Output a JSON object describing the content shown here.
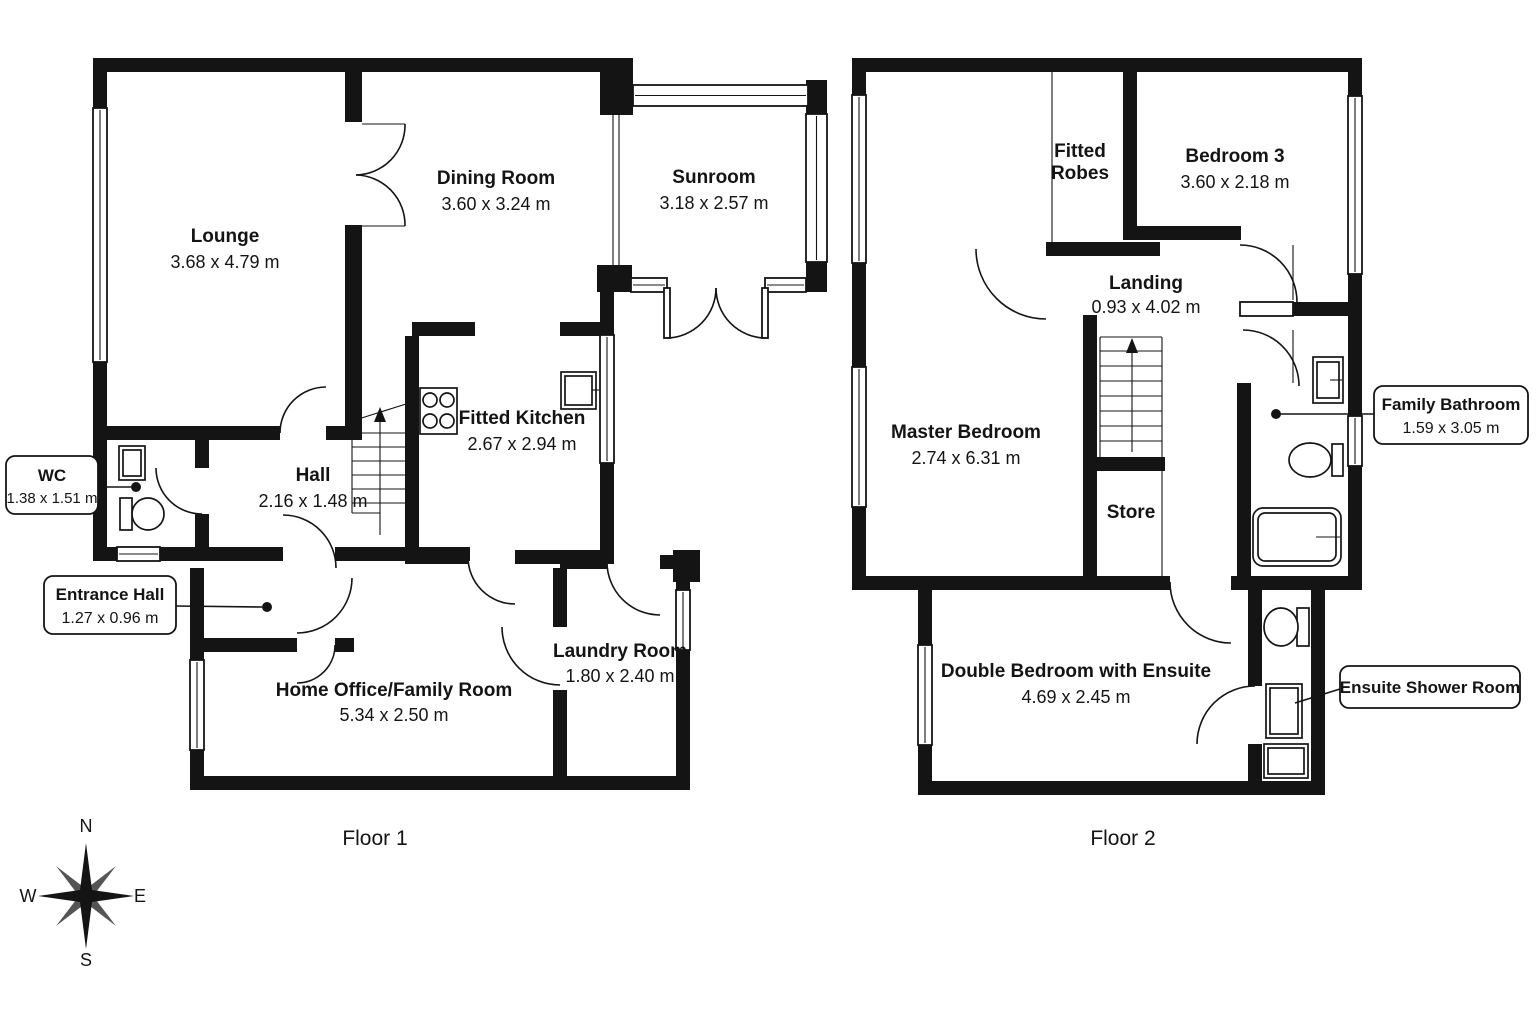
{
  "colors": {
    "ink": "#141414",
    "background": "#ffffff"
  },
  "floor1": {
    "label": "Floor 1",
    "lounge": {
      "name": "Lounge",
      "dims": "3.68 x 4.79 m"
    },
    "dining": {
      "name": "Dining Room",
      "dims": "3.60 x 3.24 m"
    },
    "sunroom": {
      "name": "Sunroom",
      "dims": "3.18 x 2.57 m"
    },
    "kitchen": {
      "name": "Fitted Kitchen",
      "dims": "2.67 x 2.94 m"
    },
    "hall": {
      "name": "Hall",
      "dims": "2.16 x 1.48 m"
    },
    "wc": {
      "name": "WC",
      "dims": "1.38 x 1.51 m"
    },
    "entrance": {
      "name": "Entrance Hall",
      "dims": "1.27 x 0.96 m"
    },
    "home_office": {
      "name": "Home Office/Family Room",
      "dims": "5.34 x 2.50 m"
    },
    "laundry": {
      "name": "Laundry Room",
      "dims": "1.80 x 2.40 m"
    }
  },
  "floor2": {
    "label": "Floor 2",
    "fitted_robes": {
      "line1": "Fitted",
      "line2": "Robes"
    },
    "bedroom3": {
      "name": "Bedroom 3",
      "dims": "3.60 x 2.18 m"
    },
    "landing": {
      "name": "Landing",
      "dims": "0.93 x 4.02 m"
    },
    "master": {
      "name": "Master Bedroom",
      "dims": "2.74 x 6.31 m"
    },
    "store": {
      "name": "Store"
    },
    "family_bathroom": {
      "name": "Family Bathroom",
      "dims": "1.59 x 3.05 m"
    },
    "double_bedroom": {
      "name": "Double Bedroom with Ensuite",
      "dims": "4.69 x 2.45 m"
    },
    "ensuite": {
      "name": "Ensuite Shower Room"
    }
  },
  "compass": {
    "north": "N",
    "south": "S",
    "east": "E",
    "west": "W"
  }
}
